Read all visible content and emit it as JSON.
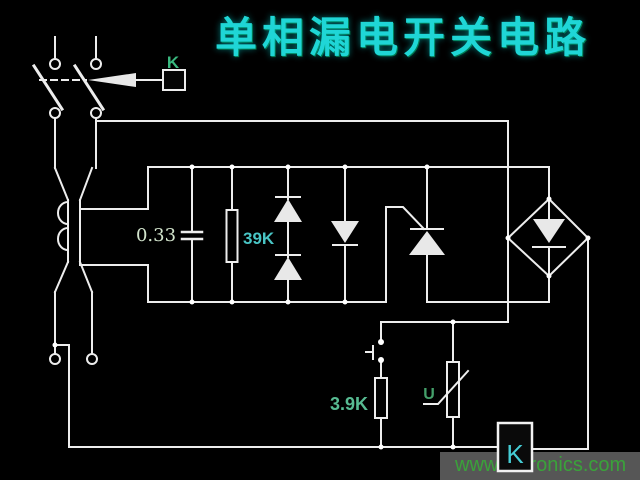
{
  "title": "单相漏电开关电路",
  "watermark": "www.cntronics.com",
  "labels": {
    "relay_link": "K",
    "relay_coil": "K",
    "capacitance": "0.33",
    "gate_resistor": "39K",
    "test_resistor": "3.9K",
    "varistor": "U"
  },
  "colors": {
    "background": "#000000",
    "wire": "#ededed",
    "title_text": "#1fd6d6",
    "label_teal": "#49c5c5",
    "label_green": "#3ab87f",
    "label_pale": "#d2e4cc",
    "label_olive_green": "#57bb92",
    "label_u_green": "#44a06a",
    "relay_k_cyan": "#45cdd5",
    "watermark_text": "#3aa23a",
    "watermark_band": "#565656"
  }
}
